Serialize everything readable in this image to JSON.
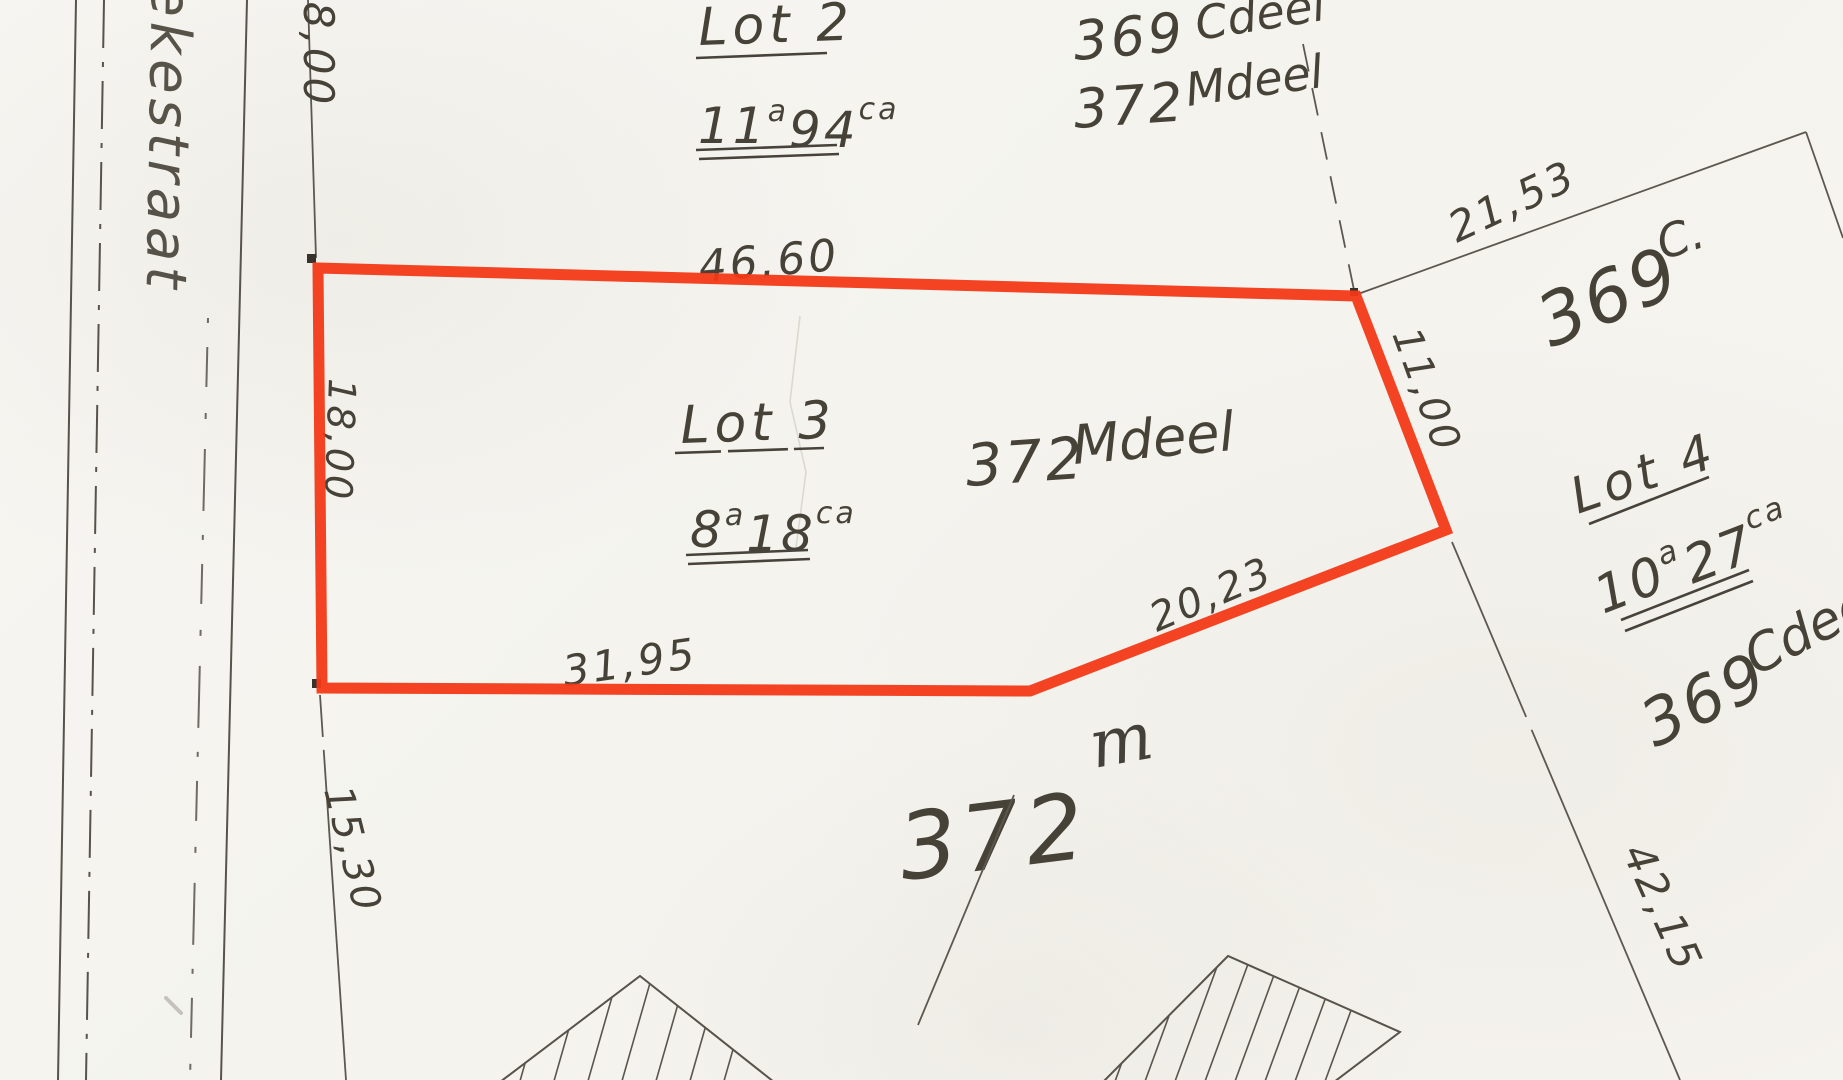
{
  "street": {
    "name": "ekestraat"
  },
  "lots": {
    "lot2": {
      "title": "Lot 2",
      "area": {
        "a": "11",
        "a_unit": "a",
        "ca": "94",
        "ca_unit": "ca"
      }
    },
    "lot3": {
      "title": "Lot 3",
      "area": {
        "a": "8",
        "a_unit": "a",
        "ca": "18",
        "ca_unit": "ca"
      }
    },
    "lot4": {
      "title": "Lot 4",
      "area": {
        "a": "10",
        "a_unit": "a",
        "ca": "27",
        "ca_unit": "ca"
      }
    }
  },
  "parcels": {
    "top_369": {
      "number": "369",
      "suffix": "Cdeel"
    },
    "top_372": {
      "number": "372",
      "suffix": "Mdeel"
    },
    "mid_372": {
      "number": "372",
      "suffix": "Mdeel"
    },
    "right_369": {
      "number": "369",
      "suffix": "C."
    },
    "bottom_right_369": {
      "number": "369",
      "suffix": "Cdeel"
    },
    "bottom_372": {
      "number": "372",
      "annotation": "m"
    }
  },
  "measurements": {
    "top_edge": "46.60",
    "upper_right": "21,53",
    "right_edge": "11,00",
    "left_upper": "18,00",
    "left_edge": "18,00",
    "left_lower": "15,30",
    "bottom_edge": "31,95",
    "lower_diagonal": "20,23",
    "right_lower": "42,15"
  },
  "colors": {
    "highlight": "#f23917",
    "ink": "#49443c"
  }
}
